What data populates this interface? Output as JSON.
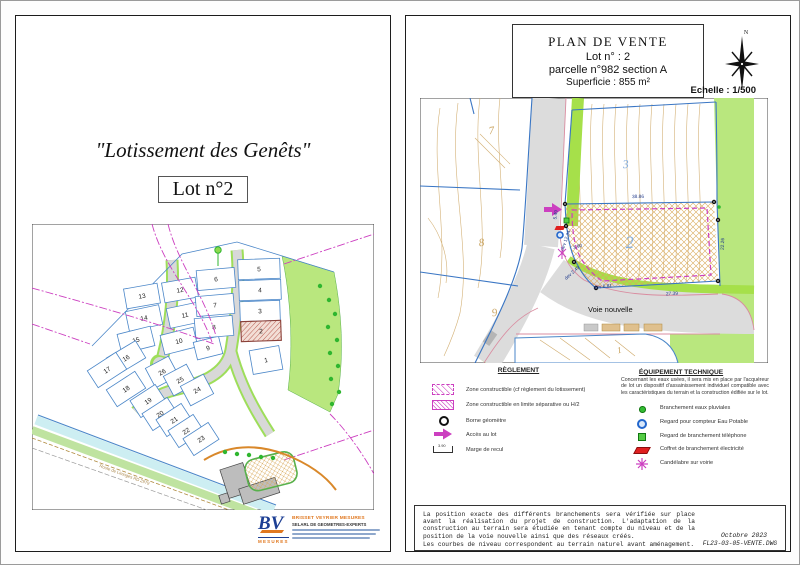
{
  "left_page": {
    "title": "\"Lotissement des Genêts\"",
    "lot_label": "Lot n°2",
    "map": {
      "road_label": "Route de Limoges RD 2979",
      "highlighted_lot": "2",
      "lots": [
        {
          "n": "13",
          "x": 110,
          "y": 72,
          "r": -10
        },
        {
          "n": "12",
          "x": 148,
          "y": 66,
          "r": -10
        },
        {
          "n": "14",
          "x": 112,
          "y": 94,
          "r": -12
        },
        {
          "n": "11",
          "x": 153,
          "y": 91,
          "r": -12
        },
        {
          "n": "15",
          "x": 104,
          "y": 116,
          "r": -14
        },
        {
          "n": "10",
          "x": 147,
          "y": 117,
          "r": -14
        },
        {
          "n": "9",
          "x": 176,
          "y": 124,
          "r": -14,
          "w": 26,
          "h": 18
        },
        {
          "n": "6",
          "x": 184,
          "y": 55,
          "r": -5,
          "w": 38
        },
        {
          "n": "7",
          "x": 183,
          "y": 81,
          "r": -5,
          "w": 38
        },
        {
          "n": "8",
          "x": 182,
          "y": 103,
          "r": -5,
          "w": 38
        },
        {
          "n": "5",
          "x": 227,
          "y": 45,
          "r": -2,
          "w": 42
        },
        {
          "n": "4",
          "x": 228,
          "y": 66,
          "r": -2,
          "w": 42
        },
        {
          "n": "3",
          "x": 228,
          "y": 87,
          "r": -2,
          "w": 40
        },
        {
          "n": "2",
          "x": 229,
          "y": 107,
          "r": -2,
          "w": 40,
          "hl": true
        },
        {
          "n": "1",
          "x": 234,
          "y": 136,
          "r": -10,
          "w": 30,
          "h": 24
        },
        {
          "n": "16",
          "x": 94,
          "y": 134,
          "r": -31
        },
        {
          "n": "17",
          "x": 75,
          "y": 146,
          "r": -33
        },
        {
          "n": "18",
          "x": 94,
          "y": 165,
          "r": -33
        },
        {
          "n": "26",
          "x": 130,
          "y": 148,
          "r": -28,
          "w": 26,
          "h": 22
        },
        {
          "n": "25",
          "x": 148,
          "y": 156,
          "r": -28,
          "w": 26,
          "h": 22
        },
        {
          "n": "24",
          "x": 165,
          "y": 166,
          "r": -28,
          "w": 26,
          "h": 22
        },
        {
          "n": "19",
          "x": 116,
          "y": 177,
          "r": -33,
          "w": 30
        },
        {
          "n": "20",
          "x": 128,
          "y": 190,
          "r": -33,
          "w": 30
        },
        {
          "n": "21",
          "x": 142,
          "y": 196,
          "r": -33,
          "w": 30
        },
        {
          "n": "22",
          "x": 154,
          "y": 207,
          "r": -33,
          "w": 30
        },
        {
          "n": "23",
          "x": 169,
          "y": 215,
          "r": -33,
          "w": 30
        }
      ],
      "trees": [
        [
          288,
          62
        ],
        [
          297,
          76
        ],
        [
          303,
          90
        ],
        [
          296,
          103
        ],
        [
          305,
          116
        ],
        [
          298,
          129
        ],
        [
          306,
          142
        ],
        [
          299,
          155
        ],
        [
          307,
          168
        ],
        [
          300,
          180
        ],
        [
          193,
          228
        ],
        [
          205,
          230
        ],
        [
          217,
          231
        ],
        [
          229,
          233
        ],
        [
          241,
          234
        ]
      ]
    },
    "logo": {
      "initials": "BV",
      "brand": "MESURES",
      "company_line1": "BRISSET VEYRIER MESURES",
      "company_line2": "SELARL DE GEOMETRES-EXPERTS"
    }
  },
  "right_page": {
    "header": {
      "line1": "PLAN DE VENTE",
      "line2": "Lot  n° : 2",
      "line3": "parcelle n°982 section A",
      "line4": "Superficie : 855 m²"
    },
    "compass_label": "N",
    "scale_label": "Echelle : 1/500",
    "map": {
      "labels": [
        {
          "t": "2",
          "x": 210,
          "y": 150,
          "fs": 17,
          "r": -4,
          "cls": "lotBlue"
        },
        {
          "t": "3",
          "x": 206,
          "y": 70,
          "fs": 12,
          "r": -4,
          "cls": "lotBlue"
        },
        {
          "t": "7",
          "x": 72,
          "y": 36,
          "fs": 11,
          "r": -8,
          "cls": "lotTan"
        },
        {
          "t": "8",
          "x": 62,
          "y": 148,
          "fs": 11,
          "r": -8,
          "cls": "lotTan"
        },
        {
          "t": "9",
          "x": 75,
          "y": 218,
          "fs": 11,
          "r": -8,
          "cls": "lotTan"
        },
        {
          "t": "1",
          "x": 200,
          "y": 255,
          "fs": 9,
          "r": -12,
          "cls": "lotTan"
        },
        {
          "t": "Voie nouvelle",
          "x": 168,
          "y": 214,
          "fs": 7.5,
          "r": 0,
          "cls": "roadLbl"
        }
      ],
      "dimensions": [
        {
          "t": "38.86",
          "x": 218,
          "y": 100,
          "r": -1
        },
        {
          "t": "27.39",
          "x": 252,
          "y": 197,
          "r": -3
        },
        {
          "t": "22.26",
          "x": 304,
          "y": 146,
          "r": -88
        },
        {
          "t": "5.49",
          "x": 137,
          "y": 117,
          "r": -82
        },
        {
          "t": "dev 12.34",
          "x": 147,
          "y": 143,
          "r": -70
        },
        {
          "t": "3.90",
          "x": 158,
          "y": 150,
          "r": -15
        },
        {
          "t": "dev 2.49",
          "x": 153,
          "y": 176,
          "r": -42
        },
        {
          "t": "dev 6.81",
          "x": 183,
          "y": 190,
          "r": -6
        }
      ],
      "bornes": [
        [
          145,
          106
        ],
        [
          294,
          104
        ],
        [
          298,
          183
        ],
        [
          176,
          190
        ],
        [
          154,
          164
        ],
        [
          146,
          128
        ],
        [
          298,
          122
        ]
      ]
    },
    "legend_left": {
      "title": "RÈGLEMENT",
      "items": [
        "Zone constructible (cf règlement du lotissement)",
        "Zone constructible en limite séparative ou H/2",
        "Borne géomètre",
        "Accès au lot",
        "Marge de recul"
      ],
      "marge_value": "3.90"
    },
    "legend_right": {
      "title": "ÉQUIPEMENT TECHNIQUE",
      "note": "Concernant les eaux usées, il sera mis en place par l'acquéreur de lot un dispositif d'assainissement individuel compatible avec les caractéristiques du terrain et la construction édifiée sur le lot.",
      "items": [
        "Branchement  eaux pluviales",
        "Regard pour compteur Eau Potable",
        "Regard de branchement téléphone",
        "Coffret de branchement électricité",
        "Candélabre sur voirie"
      ]
    },
    "footer": {
      "para1": "La position exacte des différents branchements sera vérifiée sur place  avant la réalisation du projet de construction. L'adaptation de la construction au terrain sera étudiée en tenant compte du niveau et de la position de la voie nouvelle ainsi que des réseaux créés.",
      "para2": "Les courbes de niveau correspondent au terrain naturel avant aménagement.",
      "date": "Octobre 2023",
      "file": "FL23-03-05-VENTE.DWG"
    }
  },
  "colors": {
    "parcel_blue": "#4a86c8",
    "cadastre_magenta": "#cc3fc0",
    "green_area": "#b9e77e",
    "verge_green": "#a6e04a",
    "road_gray": "#dcdcdc",
    "contour_tan": "#cfa968",
    "dim_navy": "#203a8c",
    "hatch_red": "#b85c50"
  }
}
